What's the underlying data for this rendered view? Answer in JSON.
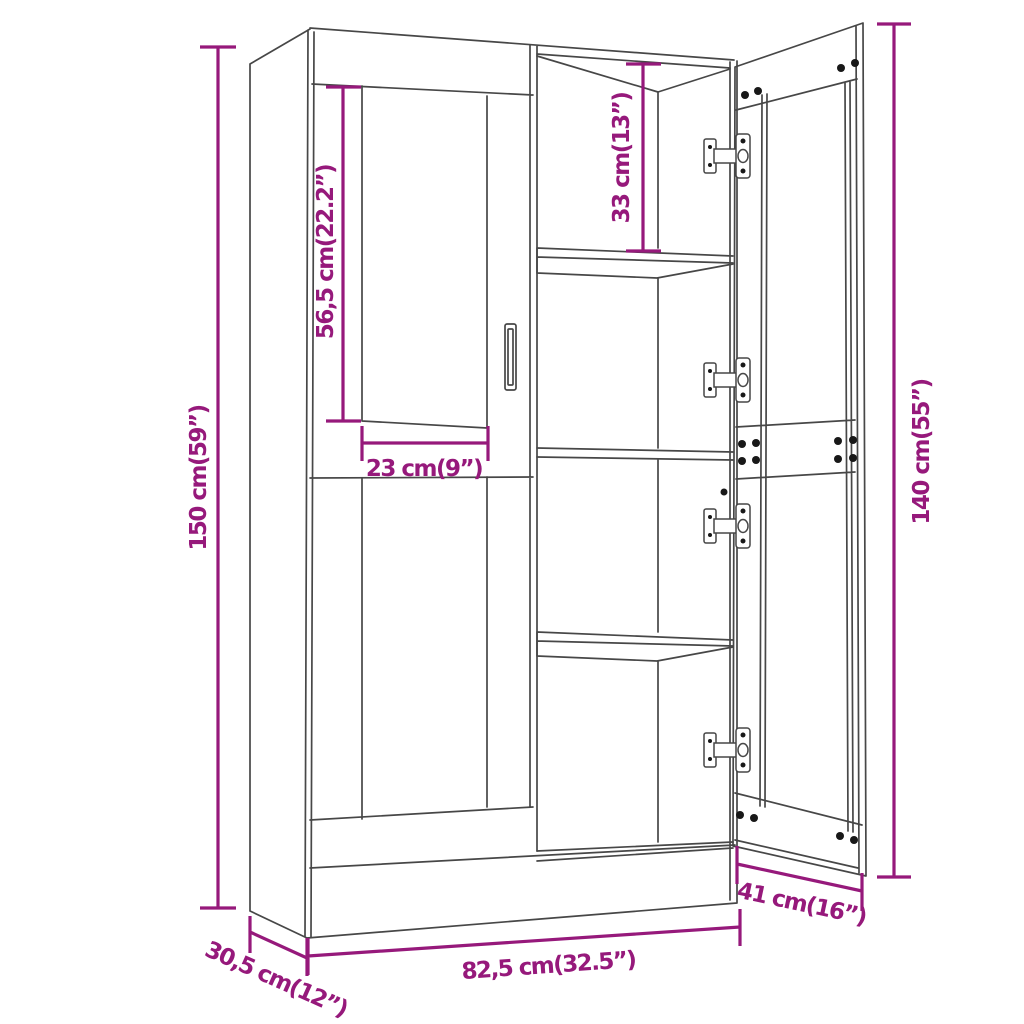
{
  "page": {
    "background": "#ffffff"
  },
  "diagram": {
    "title": "display cabinet dimension drawing",
    "colors": {
      "dimension_accent": "#96197B",
      "outline": "#474747",
      "screws": "#181818"
    },
    "dimensions": {
      "total_height": "150 cm(59”)",
      "glass_panel_height": "56,5 cm(22.2”)",
      "top_compartment_height": "33 cm(13”)",
      "glass_panel_width": "23 cm(9”)",
      "door_height": "140 cm(55”)",
      "door_width": "41 cm(16”)",
      "total_width": "82,5 cm(32.5”)",
      "total_depth": "30,5 cm(12”)"
    }
  }
}
